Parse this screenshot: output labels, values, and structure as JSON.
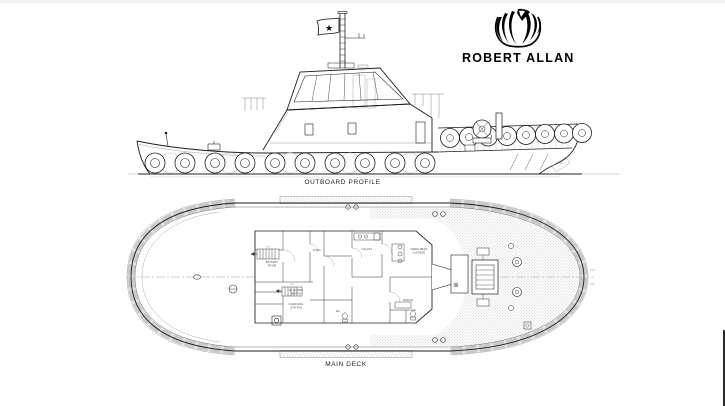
{
  "page": {
    "background": "#ffffff",
    "top_bar_color": "#f1f1f4"
  },
  "logo": {
    "brand": "ROBERT ALLAN",
    "emblem": "robert-allan-swirl-emblem"
  },
  "icons": {
    "flag_star": "★"
  },
  "profile": {
    "caption": "OUTBOARD PROFILE"
  },
  "deck": {
    "caption": "MAIN DECK",
    "room_labels": [
      "BATTERY",
      "ROOM",
      "HVAC",
      "GALLEY",
      "CREW MESS",
      "/LOUNGE",
      "AC SHORE",
      "SWITCH",
      "CHARGING",
      "STATION",
      "WC",
      "OFFICE",
      "UP",
      "UP"
    ]
  },
  "colors": {
    "line_dark": "#1d1d1d",
    "line_faint": "#999999",
    "hatch": "#d6d6d6"
  }
}
